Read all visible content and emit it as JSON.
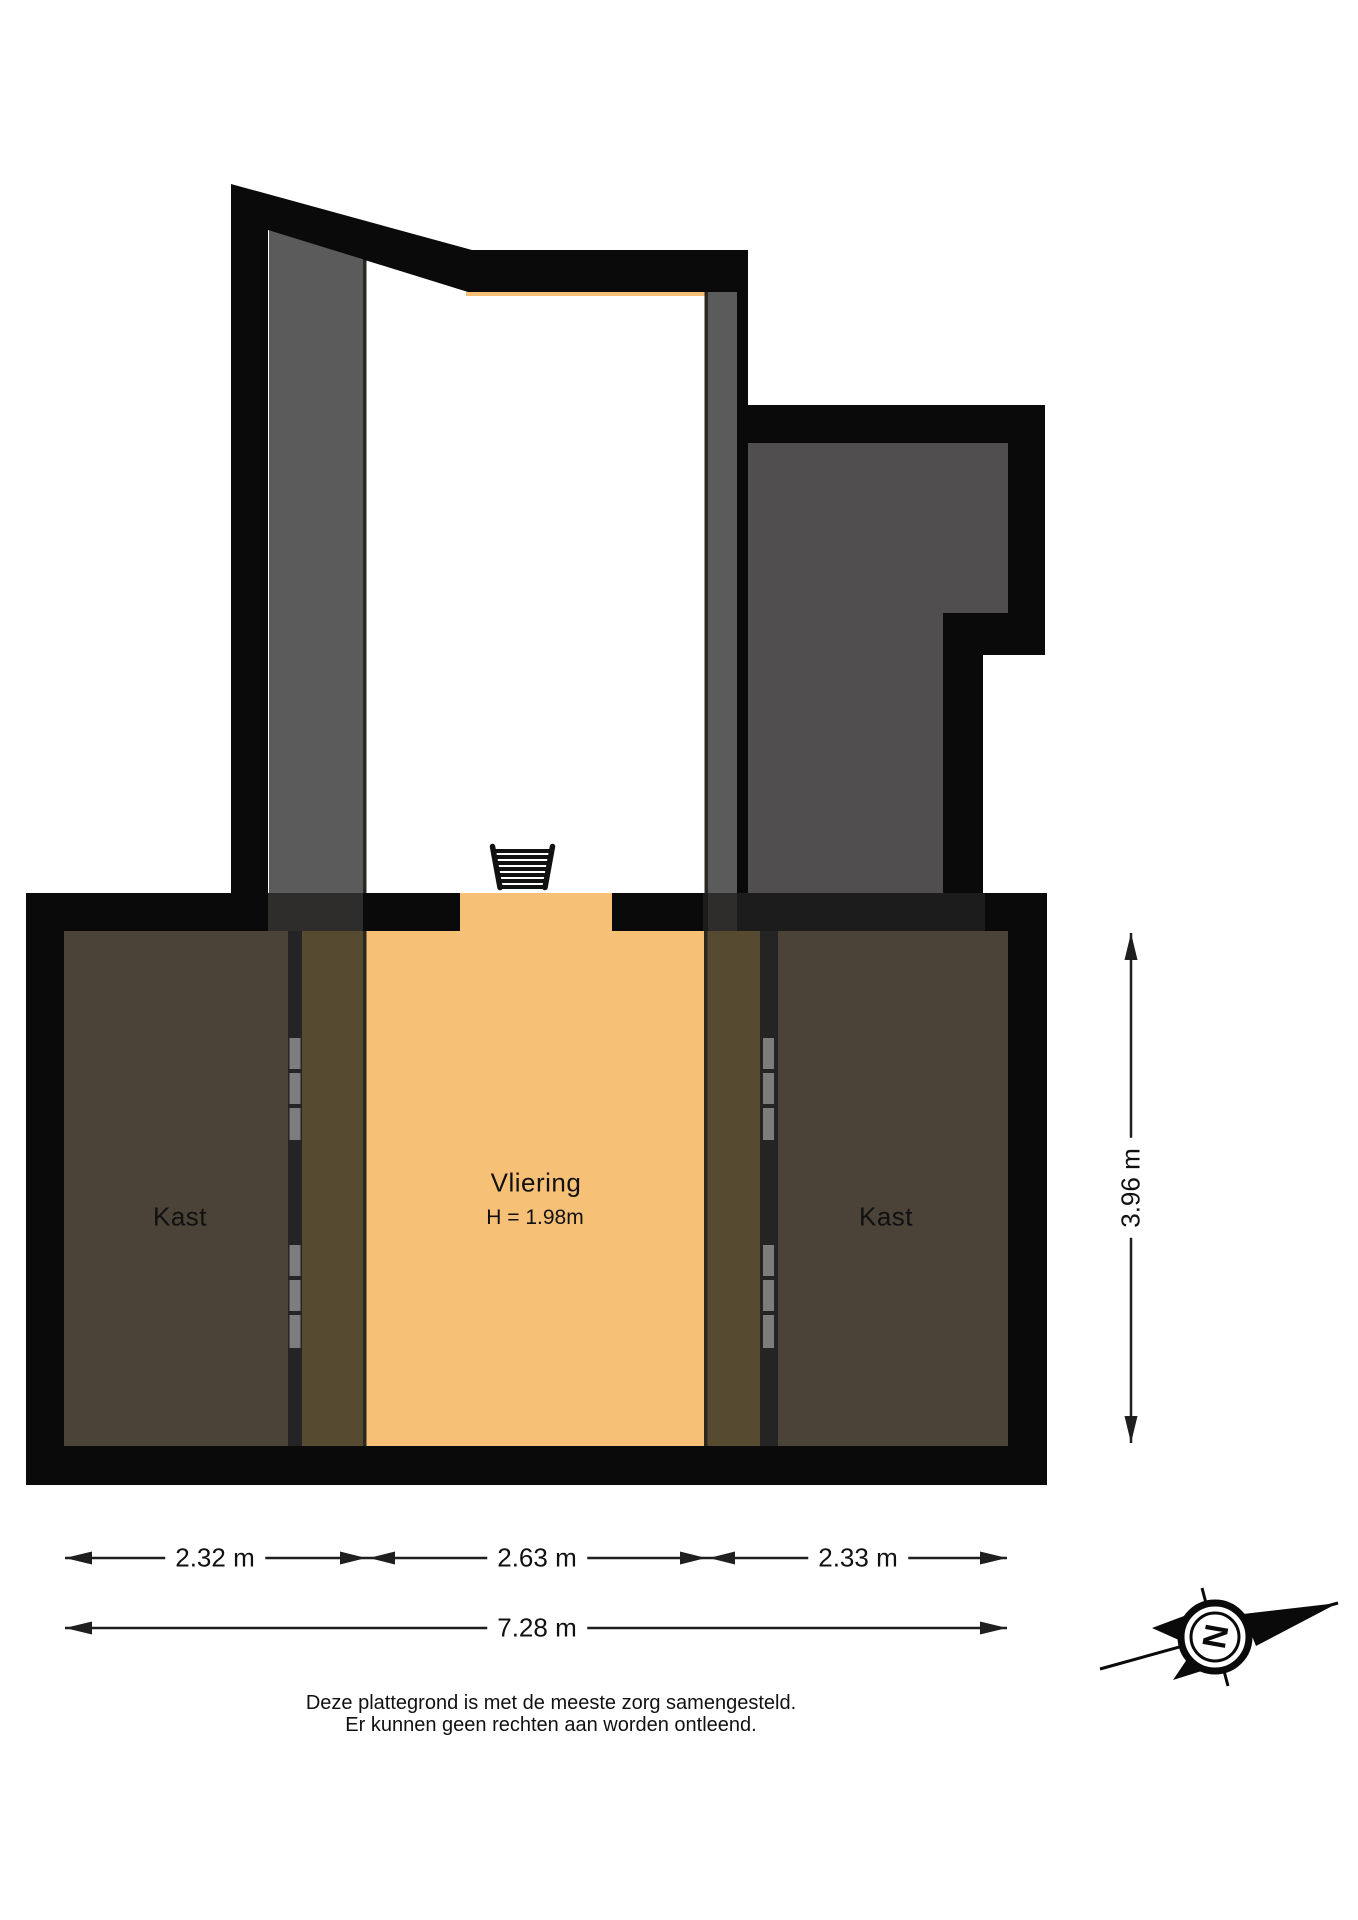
{
  "rooms": {
    "vliering": {
      "label": "Vliering",
      "height_note": "H = 1.98m"
    },
    "kast_left": {
      "label": "Kast"
    },
    "kast_right": {
      "label": "Kast"
    }
  },
  "dimensions": {
    "width_segments": [
      "2.32 m",
      "2.63 m",
      "2.33 m"
    ],
    "width_total": "7.28 m",
    "height_total": "3.96 m"
  },
  "compass": {
    "north_letter": "N"
  },
  "disclaimer": {
    "line1": "Deze plattegrond is met de meeste zorg samengesteld.",
    "line2": "Er kunnen geen rechten aan worden ontleend."
  },
  "colors": {
    "bg": "#ffffff",
    "wall": "#0a0a0a",
    "wall_tint": "#1c1c1c",
    "floor": "#f7c077",
    "low": "#564a30",
    "closet": "#4b4238",
    "room_grey": "#504e4e",
    "band": "#5b5b5b",
    "band_dark": "#2e2d2b",
    "door_wall": "#242424",
    "door": "#7d7d7d",
    "line_thin": "#2a2820",
    "dim": "#1f1f1f",
    "text": "#111111"
  }
}
